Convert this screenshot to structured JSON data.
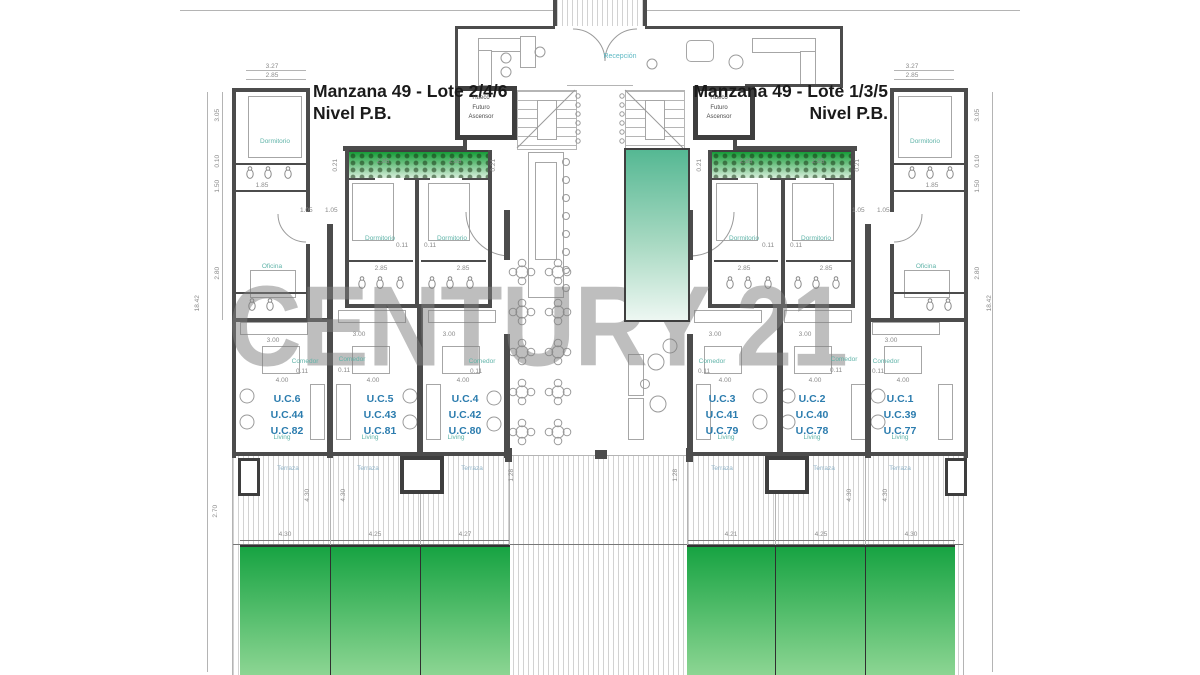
{
  "watermark": "CENTURY 21",
  "titles": {
    "left": {
      "line1": "Manzana 49 - Lote 2/4/6",
      "line2": "Nivel P.B."
    },
    "right": {
      "line1": "Manzana 49 - Lote 1/3/5",
      "line2": "Nivel P.B."
    }
  },
  "labels": {
    "reception": "Recepción",
    "elevator": "Hueco\nFuturo\nAscensor",
    "dormitorio": "Dormitorio",
    "oficina": "Oficina",
    "comedor": "Comedor",
    "living": "Living",
    "terraza": "Terraza"
  },
  "units": {
    "left": [
      {
        "codes": "U.C.6\nU.C.44\nU.C.82"
      },
      {
        "codes": "U.C.5\nU.C.43\nU.C.81"
      },
      {
        "codes": "U.C.4\nU.C.42\nU.C.80"
      }
    ],
    "right": [
      {
        "codes": "U.C.3\nU.C.41\nU.C.79"
      },
      {
        "codes": "U.C.2\nU.C.40\nU.C.78"
      },
      {
        "codes": "U.C.1\nU.C.39\nU.C.77"
      }
    ]
  },
  "dims": {
    "v327": "3.27",
    "v285": "2.85",
    "v305": "3.05",
    "v300": "3.00",
    "v185": "1.85",
    "v010": "0.10",
    "v150": "1.50",
    "v280": "2.80",
    "v1842": "18.42",
    "v011": "0.11",
    "v400": "4.00",
    "v105": "1.05",
    "v430": "4.30",
    "v425": "4.25",
    "v427": "4.27",
    "v421": "4.21",
    "v270": "2.70",
    "v021": "0.21",
    "v128": "1.28"
  },
  "colors": {
    "wall": "#4c4c4c",
    "room_label": "#5fb3a8",
    "terrace_label": "#8fb2c7",
    "unit_code": "#2b7cae",
    "dim_text": "#8a8a8a",
    "garden_top": "#17a342",
    "garden_bottom": "#8ed694",
    "pool_top": "#55b893",
    "pool_bottom": "#edf7f2",
    "planter_green": "#169c38",
    "watermark_gray": "#7d7d7d"
  }
}
